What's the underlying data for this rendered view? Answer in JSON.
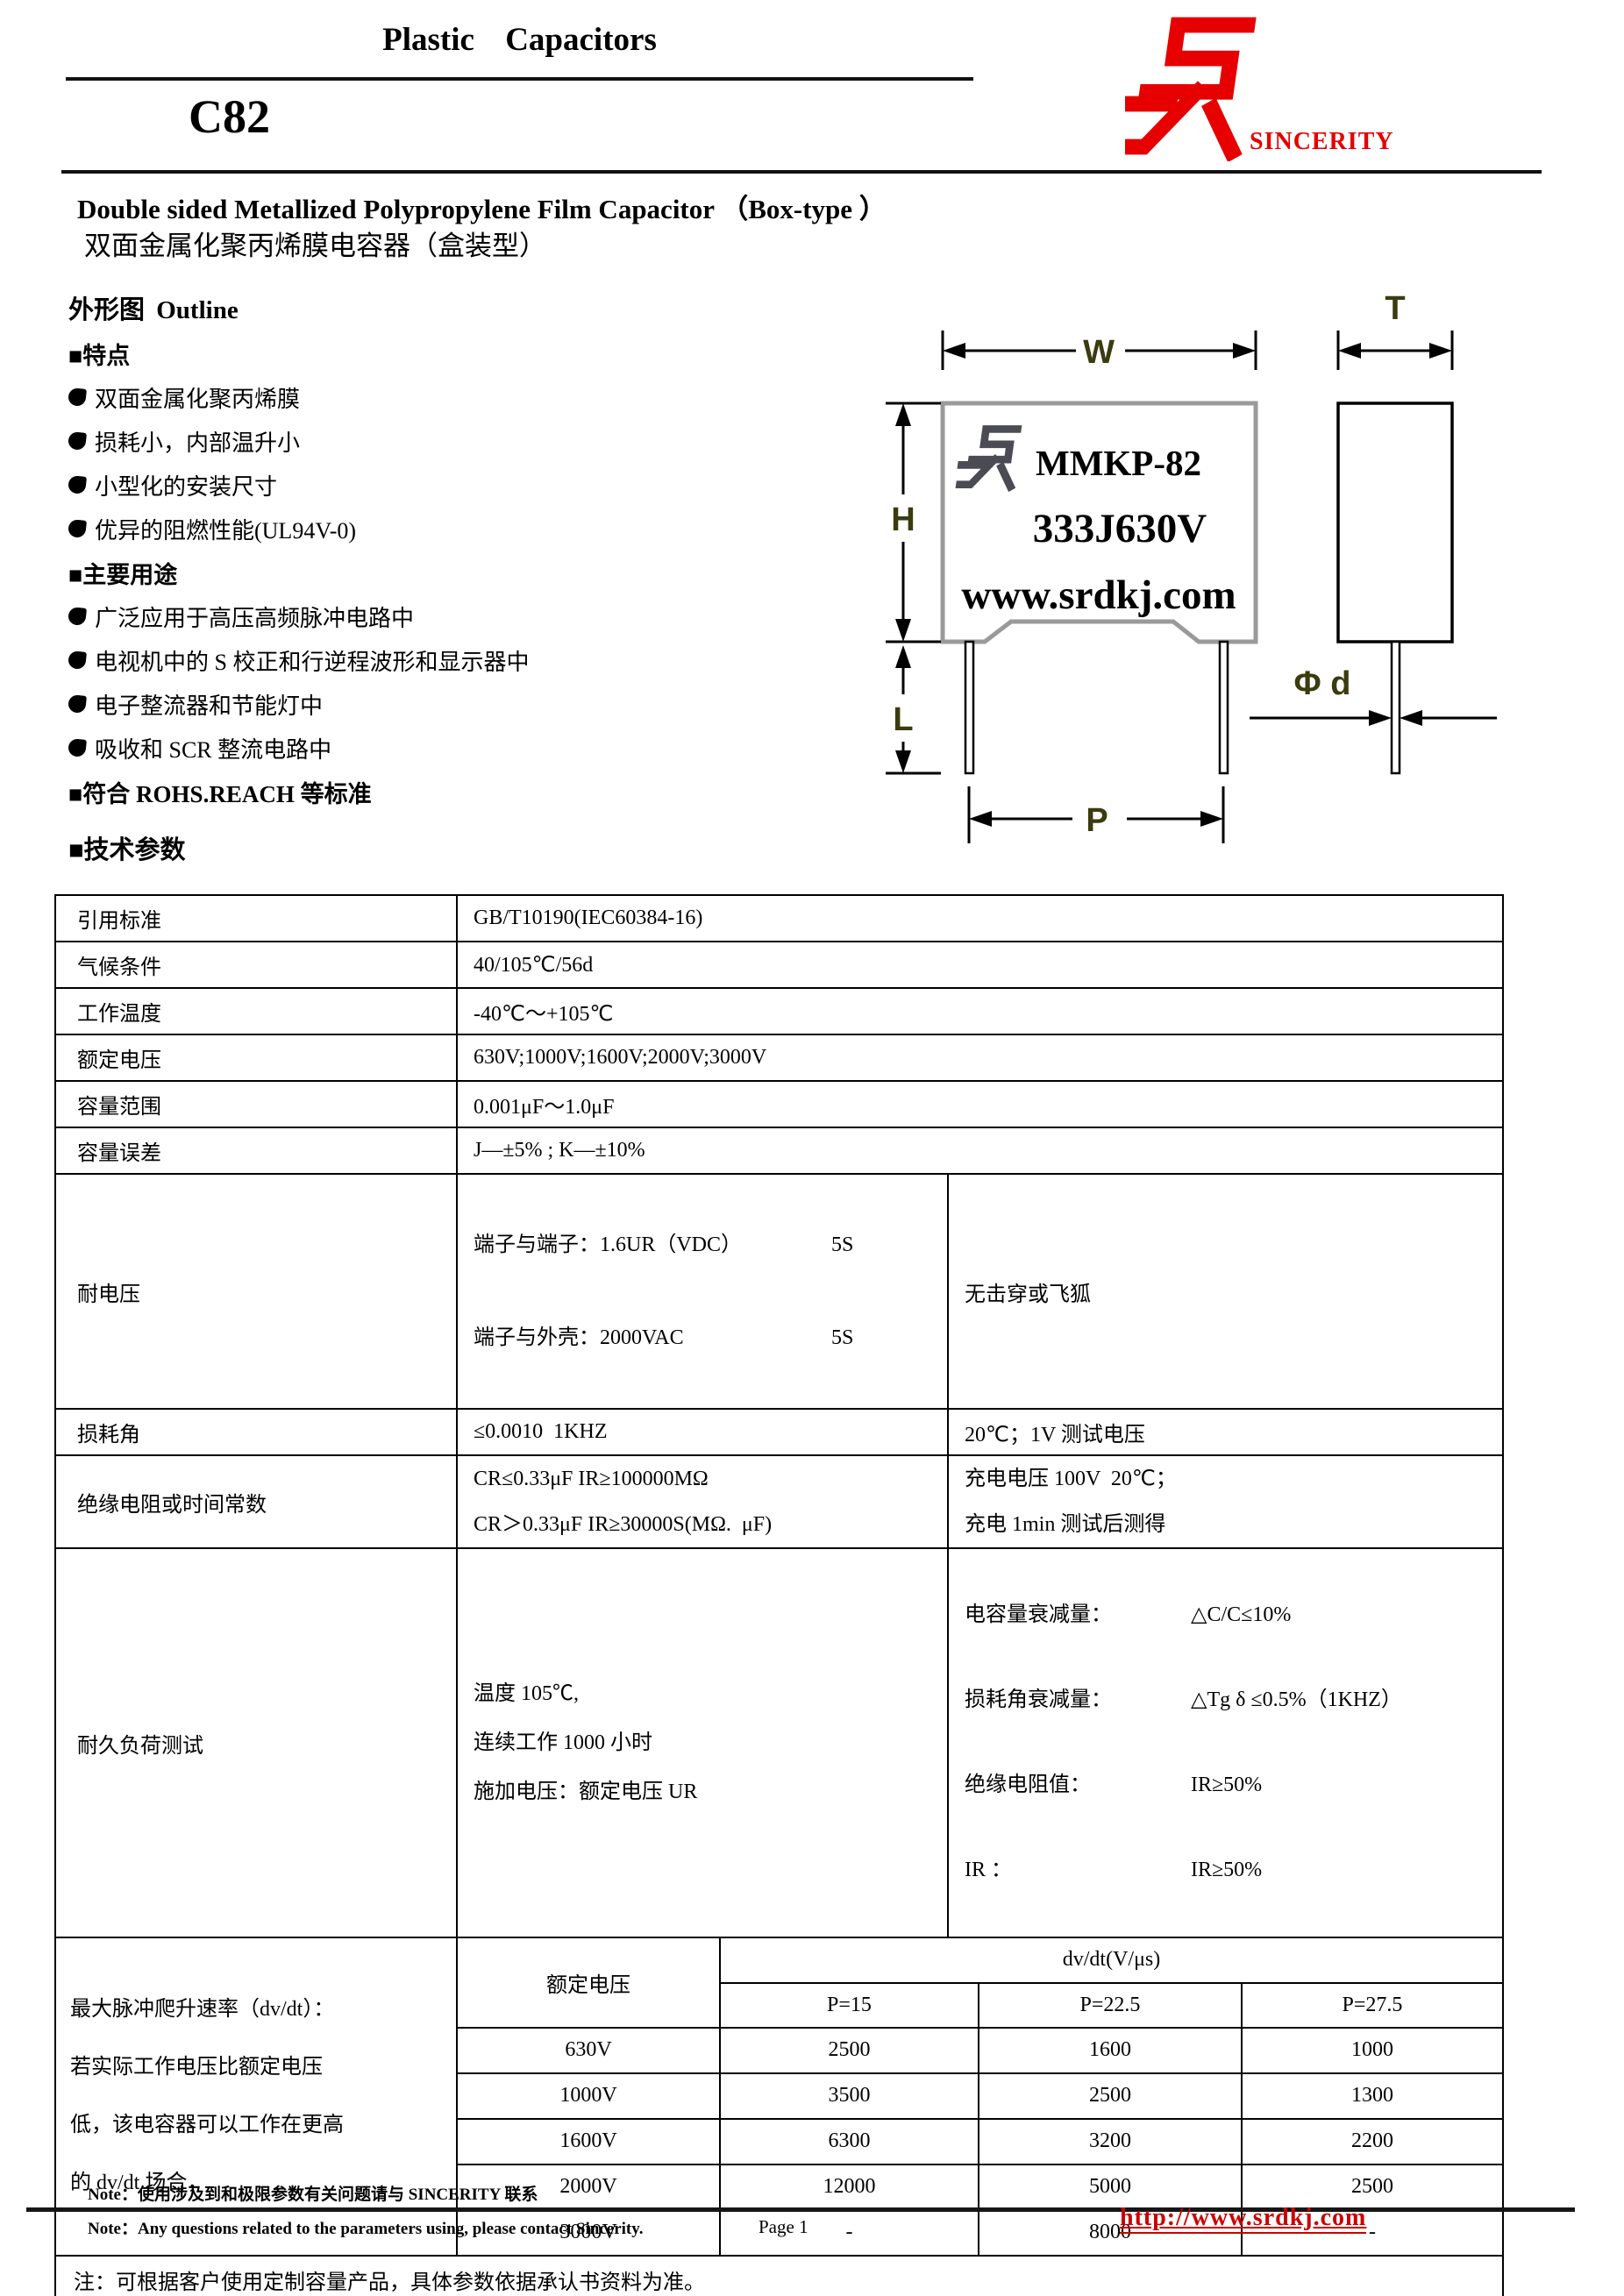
{
  "header": {
    "doc_title": "Plastic Capacitors",
    "model": "C82",
    "brand": "SINCERITY",
    "title_en": "Double sided Metallized Polypropylene Film Capacitor （Box-type  ）",
    "title_cn": "双面金属化聚丙烯膜电容器（盒装型）"
  },
  "outline": {
    "heading": "外形图 Outline",
    "features_heading": "■特点",
    "features": [
      "双面金属化聚丙烯膜",
      "损耗小，内部温升小",
      "小型化的安装尺寸",
      "优异的阻燃性能(UL94V-0)"
    ],
    "applications_heading": "■主要用途",
    "applications": [
      "广泛应用于高压高频脉冲电路中",
      "电视机中的 S 校正和行逆程波形和显示器中",
      "电子整流器和节能灯中",
      "吸收和 SCR 整流电路中"
    ],
    "compliance": "■符合 ROHS.REACH 等标准"
  },
  "diagram": {
    "dim_w": "W",
    "dim_h": "H",
    "dim_l": "L",
    "dim_p": "P",
    "dim_t": "T",
    "dim_d": "Φ d",
    "body_line1": "MMKP-82",
    "body_line2": "333J630V",
    "body_line3": "www.srdkj.com",
    "label_color": "#3b3b10",
    "body_stroke": "#9a9a9a",
    "logo_color": "#4b4b55"
  },
  "tech": {
    "heading": "■技术参数",
    "rows": [
      {
        "label": "引用标准",
        "value": "GB/T10190(IEC60384-16)"
      },
      {
        "label": "气候条件",
        "value": "40/105℃/56d"
      },
      {
        "label": "工作温度",
        "value": "-40℃～+105℃"
      },
      {
        "label": "额定电压",
        "value": "630V;1000V;1600V;2000V;3000V"
      },
      {
        "label": "容量范围",
        "value": "0.001μF～1.0μF"
      },
      {
        "label": "容量误差",
        "value": "J—±5% ; K—±10%"
      },
      {
        "label": "耐电压",
        "pairs": [
          {
            "l": "端子与端子：1.6UR（VDC）",
            "r": "5S"
          },
          {
            "l": "端子与外壳：2000VAC",
            "r": "5S"
          }
        ],
        "note": "无击穿或飞狐"
      },
      {
        "label": "损耗角",
        "value": "≤0.0010  1KHZ",
        "note": "20℃；1V 测试电压"
      },
      {
        "label": "绝缘电阻或时间常数",
        "value": "CR≤0.33μF IR≥100000MΩ\nCR＞0.33μF IR≥30000S(MΩ.  μF)",
        "note": "充电电压 100V  20℃；\n充电 1min 测试后测得"
      },
      {
        "label": "耐久负荷测试",
        "value": "温度 105℃,\n连续工作 1000 小时\n施加电压：额定电压 UR",
        "note_pairs": [
          {
            "l": "电容量衰减量：",
            "r": "△C/C≤10%"
          },
          {
            "l": "损耗角衰减量：",
            "r": "△Tg δ ≤0.5%（1KHZ）"
          },
          {
            "l": "绝缘电阻值：",
            "r": "IR≥50%"
          },
          {
            "l": "IR ：",
            "r": "IR≥50%"
          }
        ]
      }
    ],
    "dvdt": {
      "desc": "最大脉冲爬升速率（dv/dt）：\n若实际工作电压比额定电压\n低，该电容器可以工作在更高\n的 dv/dt 场合，",
      "col_voltage": "额定电压",
      "col_dvdt": "dv/dt(V/μs)",
      "pitch_headers": [
        "P=15",
        "P=22.5",
        "P=27.5"
      ],
      "rows": [
        {
          "voltage": "630V",
          "values": [
            "2500",
            "1600",
            "1000"
          ]
        },
        {
          "voltage": "1000V",
          "values": [
            "3500",
            "2500",
            "1300"
          ]
        },
        {
          "voltage": "1600V",
          "values": [
            "6300",
            "3200",
            "2200"
          ]
        },
        {
          "voltage": "2000V",
          "values": [
            "12000",
            "5000",
            "2500"
          ]
        },
        {
          "voltage": "3000V",
          "values": [
            "-",
            "8000",
            "-"
          ]
        }
      ]
    },
    "note": "注：可根据客户使用定制容量产品，具体参数依据承认书资料为准。"
  },
  "footer": {
    "note_cn": "Note：使用涉及到和极限参数有关问题请与 SINCERITY 联系",
    "note_en": "Note：Any questions related to the parameters using, please contact Sincerity.",
    "page": "Page 1",
    "url": "http://www.srdkj.com"
  }
}
